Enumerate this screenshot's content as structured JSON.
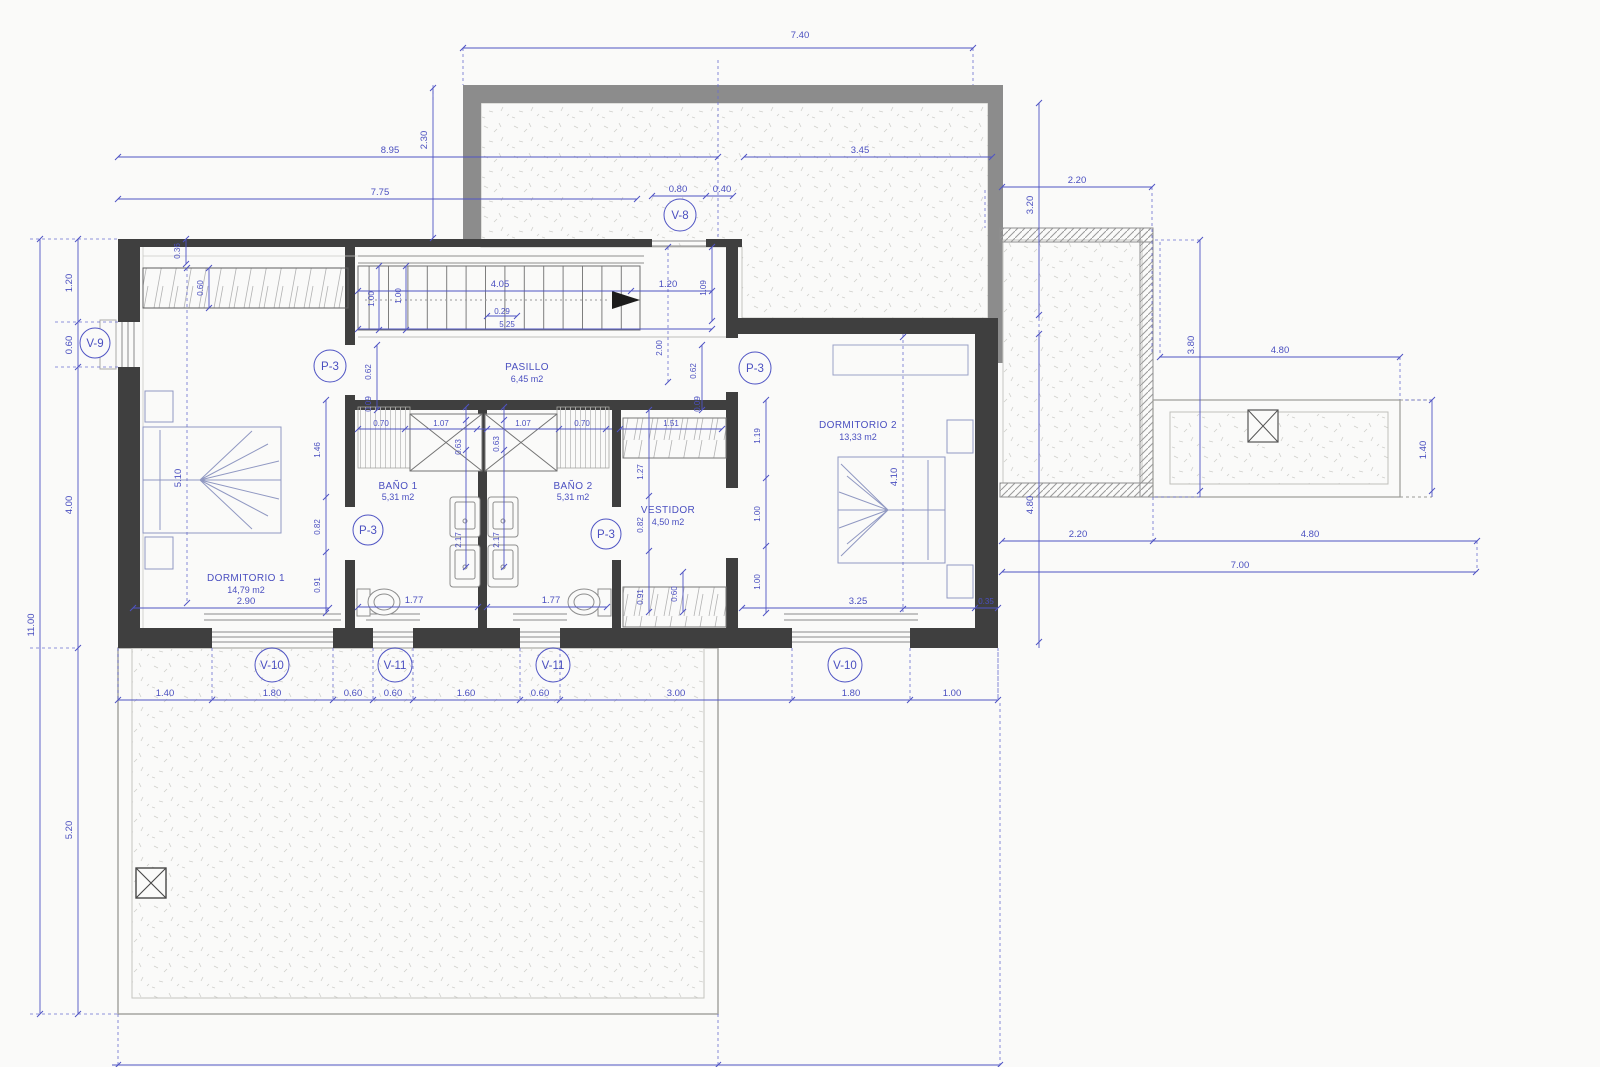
{
  "plan": {
    "rooms": {
      "dormitorio1": {
        "name": "DORMITORIO 1",
        "area": "14,79 m2"
      },
      "dormitorio2": {
        "name": "DORMITORIO 2",
        "area": "13,33 m2"
      },
      "bano1": {
        "name": "BAÑO 1",
        "area": "5,31 m2"
      },
      "bano2": {
        "name": "BAÑO 2",
        "area": "5,31 m2"
      },
      "pasillo": {
        "name": "PASILLO",
        "area": "6,45 m2"
      },
      "vestidor": {
        "name": "VESTIDOR",
        "area": "4,50 m2"
      }
    },
    "openings": {
      "v8": "V-8",
      "v9": "V-9",
      "v10_left": "V-10",
      "v11_left": "V-11",
      "v11_mid": "V-11",
      "v10_right": "V-10",
      "p3_dorm1": "P-3",
      "p3_dorm2": "P-3",
      "p3_bano1": "P-3",
      "p3_bano2": "P-3"
    },
    "dims": {
      "total_w_top": "7.40",
      "left_895": "8.95",
      "left_775": "7.75",
      "terr_230": "2.30",
      "top_345": "3.45",
      "v8_080": "0.80",
      "v8_040": "0.40",
      "tr_220": "2.20",
      "tr_320": "3.20",
      "r_380": "3.80",
      "r_480_top": "4.80",
      "r_140": "1.40",
      "r_220": "2.20",
      "r_480_bot": "4.80",
      "r_700": "7.00",
      "r_480_v": "4.80",
      "l_120": "1.20",
      "l_060": "0.60",
      "l_400": "4.00",
      "l_1100": "11.00",
      "l_520": "5.20",
      "b_140": "1.40",
      "b_180a": "1.80",
      "b_060a": "0.60",
      "b_060b": "0.60",
      "b_160": "1.60",
      "b_060c": "0.60",
      "b_300": "3.00",
      "b_180b": "1.80",
      "b_100": "1.00",
      "b_660": "6.60",
      "b_300b": "3.00",
      "s_405": "4.05",
      "s_120": "1.20",
      "s_029": "0.29",
      "s_525": "5.25",
      "s_100a": "1.00",
      "s_100b": "1.00",
      "s_109": "1.09",
      "s_200": "2.00",
      "s_036": "0.36",
      "s_060": "0.60",
      "w_062a": "0.62",
      "w_062b": "0.62",
      "w_009a": "0.09",
      "w_009b": "0.09",
      "d1_510": "5.10",
      "d1_146": "1.46",
      "d1_082": "0.82",
      "d1_091": "0.91",
      "d1_290": "2.90",
      "ba_070a": "0.70",
      "ba_107a": "1.07",
      "ba_063a": "0.63",
      "ba_063b": "0.63",
      "ba_107b": "1.07",
      "ba_070b": "0.70",
      "ba_217a": "2.17",
      "ba_217b": "2.17",
      "ba_177a": "1.77",
      "ba_177b": "1.77",
      "ve_151": "1.51",
      "ve_127": "1.27",
      "ve_082": "0.82",
      "ve_091": "0.91",
      "ve_060": "0.60",
      "d2_119": "1.19",
      "d2_100a": "1.00",
      "d2_100b": "1.00",
      "d2_410": "4.10",
      "d2_325": "3.25",
      "d2_035": "0.35"
    }
  }
}
